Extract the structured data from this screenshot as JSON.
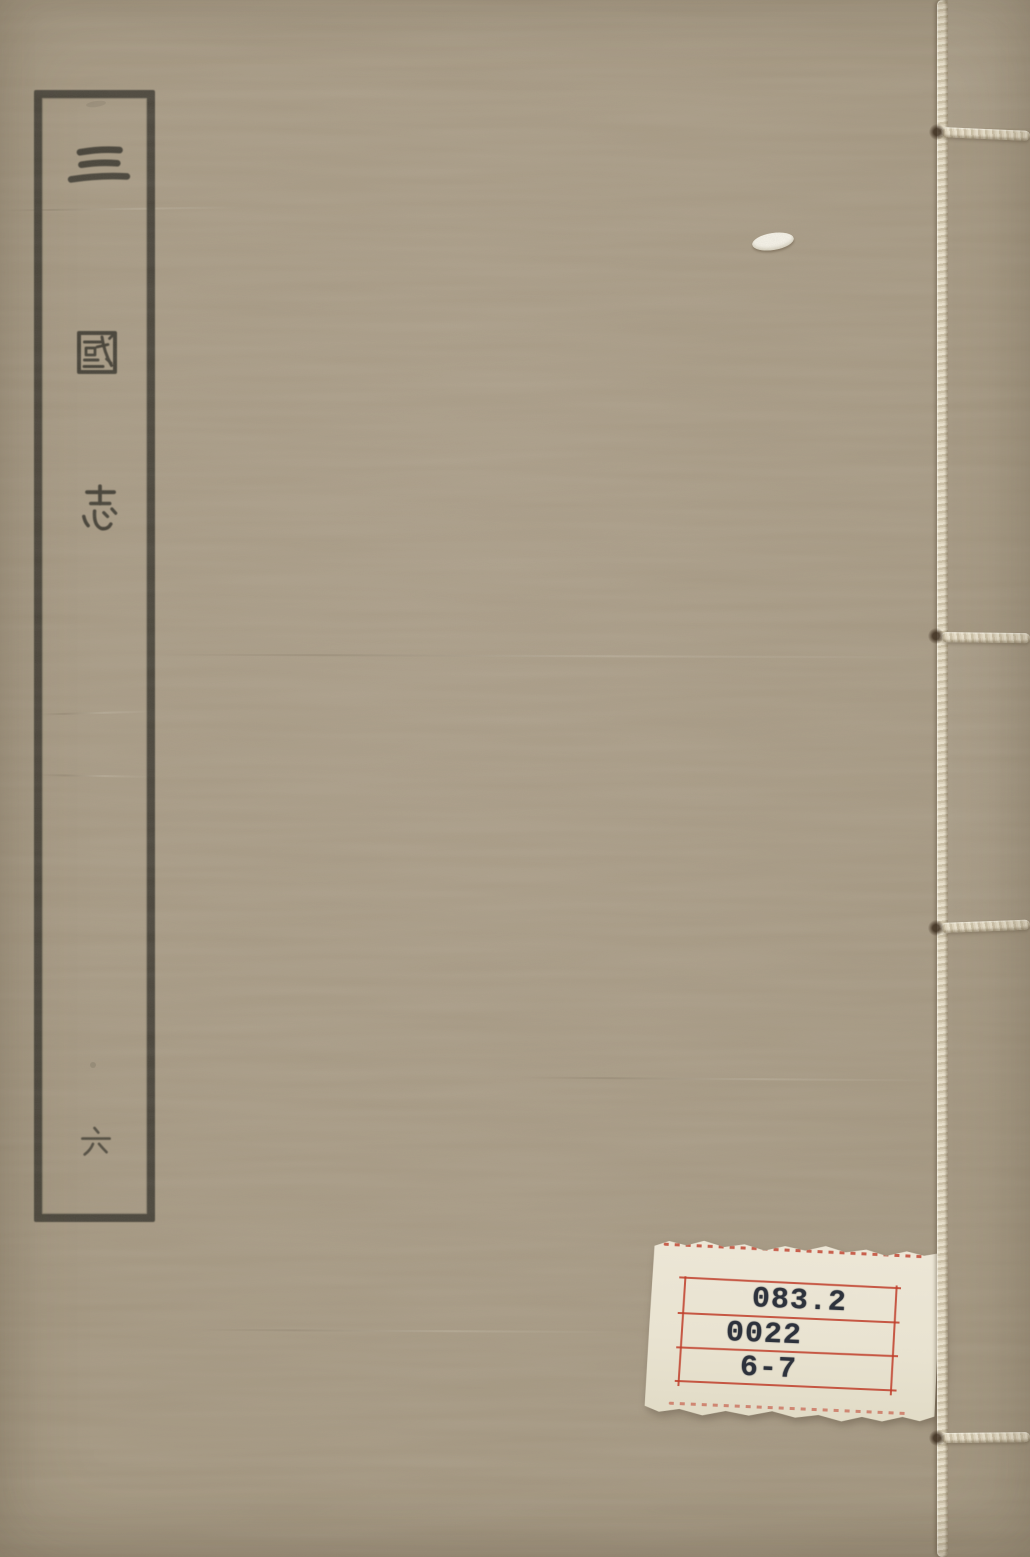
{
  "cover": {
    "title": "三國志",
    "title_chars": [
      "三",
      "國",
      "志"
    ],
    "volume_char": "六"
  },
  "library_label": {
    "rows": [
      "083.2",
      "0022",
      "6-7"
    ]
  },
  "colors": {
    "cover_background": "#a79a84",
    "title_ink": "#3b382f",
    "binding_thread": "#ddd3bd",
    "label_paper": "#e9e3d1",
    "label_rule_red": "#c03e2a",
    "label_ink": "#2d323c"
  }
}
